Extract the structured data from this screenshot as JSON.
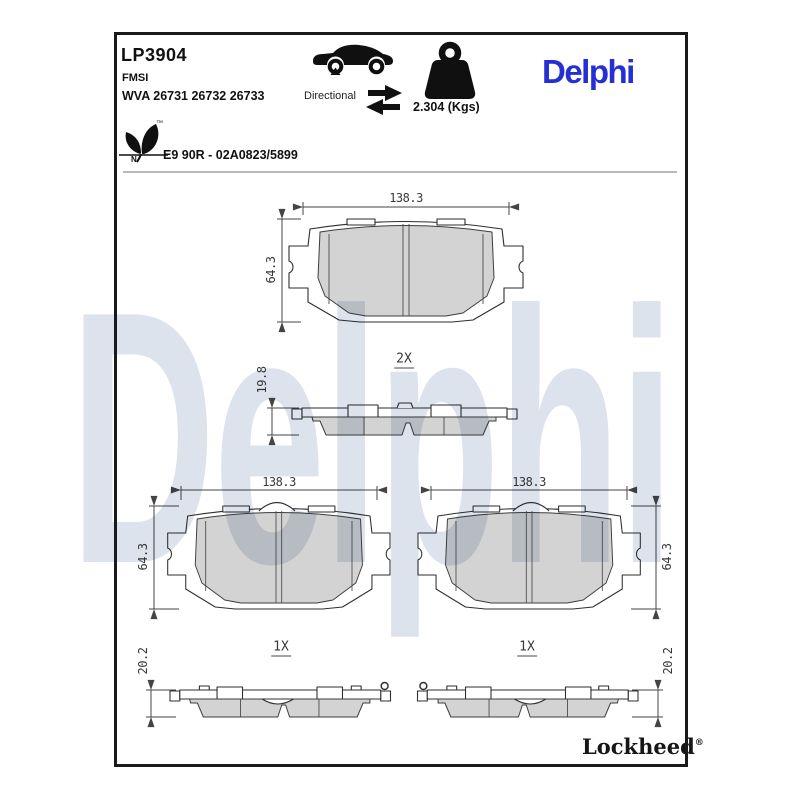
{
  "header": {
    "part_number": "LP3904",
    "fmsi_label": "FMSI",
    "wva_numbers": "WVA 26731 26732 26733",
    "directional_label": "Directional",
    "weight_value": "2.304 (Kgs)",
    "brand_logo": "Delphi",
    "homologation": "E9 90R - 02A0823/5899",
    "eco_icon_letter": "N",
    "eco_icon_tm": "™"
  },
  "watermark": "Delphi",
  "drawings": {
    "top_pair": {
      "width_mm": "138.3",
      "height_mm": "64.3",
      "quantity": "2X",
      "thickness_mm": "19.8"
    },
    "bottom_left": {
      "width_mm": "138.3",
      "height_mm": "64.3",
      "quantity": "1X",
      "thickness_mm": "20.2"
    },
    "bottom_right": {
      "width_mm": "138.3",
      "height_mm": "64.3",
      "quantity": "1X",
      "thickness_mm": "20.2"
    }
  },
  "footer": {
    "sub_brand": "Lockheed",
    "registered_mark": "®"
  },
  "colors": {
    "brand_blue": "#2430d4",
    "watermark_blue": "#dde3ec",
    "friction_gray": "#d3d3d3"
  }
}
